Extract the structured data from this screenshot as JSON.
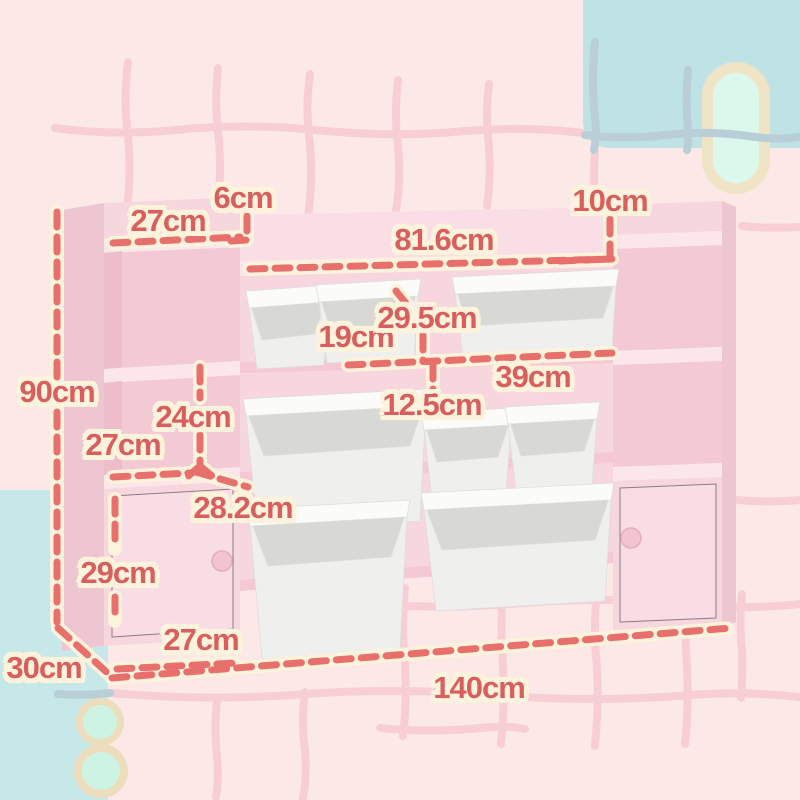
{
  "measurements": [
    {
      "id": "left-top-depth",
      "text": "27cm"
    },
    {
      "id": "left-riser-height",
      "text": "6cm"
    },
    {
      "id": "right-riser-height",
      "text": "10cm"
    },
    {
      "id": "middle-shelf-width",
      "text": "81.6cm"
    },
    {
      "id": "overall-height",
      "text": "90cm"
    },
    {
      "id": "small-bin-width",
      "text": "19cm"
    },
    {
      "id": "bin-depth",
      "text": "29.5cm"
    },
    {
      "id": "large-bin-width",
      "text": "39cm"
    },
    {
      "id": "bin-height",
      "text": "12.5cm"
    },
    {
      "id": "cubby-height",
      "text": "24cm"
    },
    {
      "id": "cubby-width",
      "text": "27cm"
    },
    {
      "id": "shelf-diagonal-depth",
      "text": "28.2cm"
    },
    {
      "id": "door-height",
      "text": "29cm"
    },
    {
      "id": "door-width",
      "text": "27cm"
    },
    {
      "id": "overall-depth",
      "text": "30cm"
    },
    {
      "id": "overall-width",
      "text": "140cm"
    }
  ],
  "product": {
    "bins": {
      "small_count": 4,
      "large_count": 4
    },
    "cabinet_doors": 2,
    "open_cubbies": 4
  },
  "colors": {
    "background_pink": "#fce9e7",
    "accent_coral_dash": "#e7706c",
    "label_text": "#d85f5e",
    "label_halo": "#fdf2dc",
    "furniture_pink": "#f7d7de",
    "bin_grey": "#efefed",
    "teal_block": "#bfe3e4",
    "cyan_block": "#c6e8e9",
    "capsule_fill": "#dcf8ec",
    "capsule_ring": "#efe4c5"
  }
}
